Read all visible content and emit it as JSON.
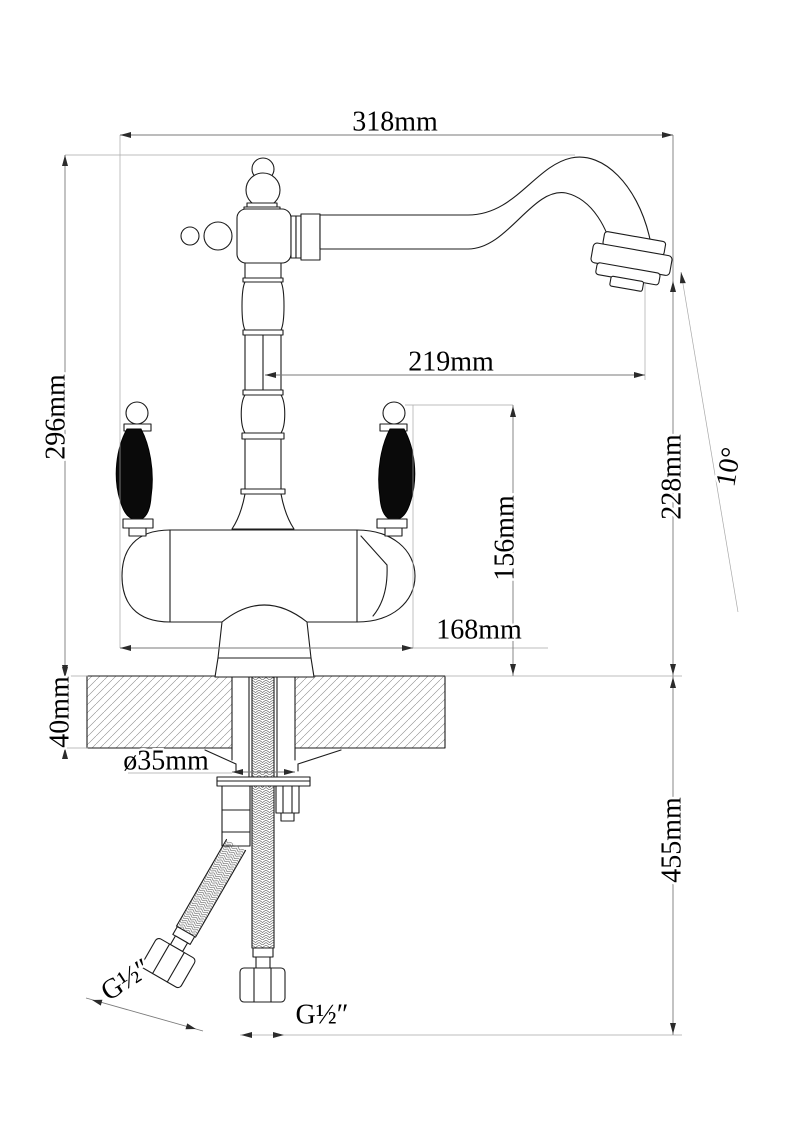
{
  "drawing": {
    "type": "technical-dimension-drawing",
    "subject": "two-handle kitchen faucet with filter, side view"
  },
  "dimensions": {
    "width_318": "318mm",
    "height_296": "296mm",
    "reach_219": "219mm",
    "outlet_height_228": "228mm",
    "angle_10": "10°",
    "handle_height_156": "156mm",
    "offset_168": "168mm",
    "counter_thickness_40": "40mm",
    "hole_diameter_35": "ø35mm",
    "hose_drop_455": "455mm",
    "thread_left": "G½″",
    "thread_bottom": "G½″"
  }
}
